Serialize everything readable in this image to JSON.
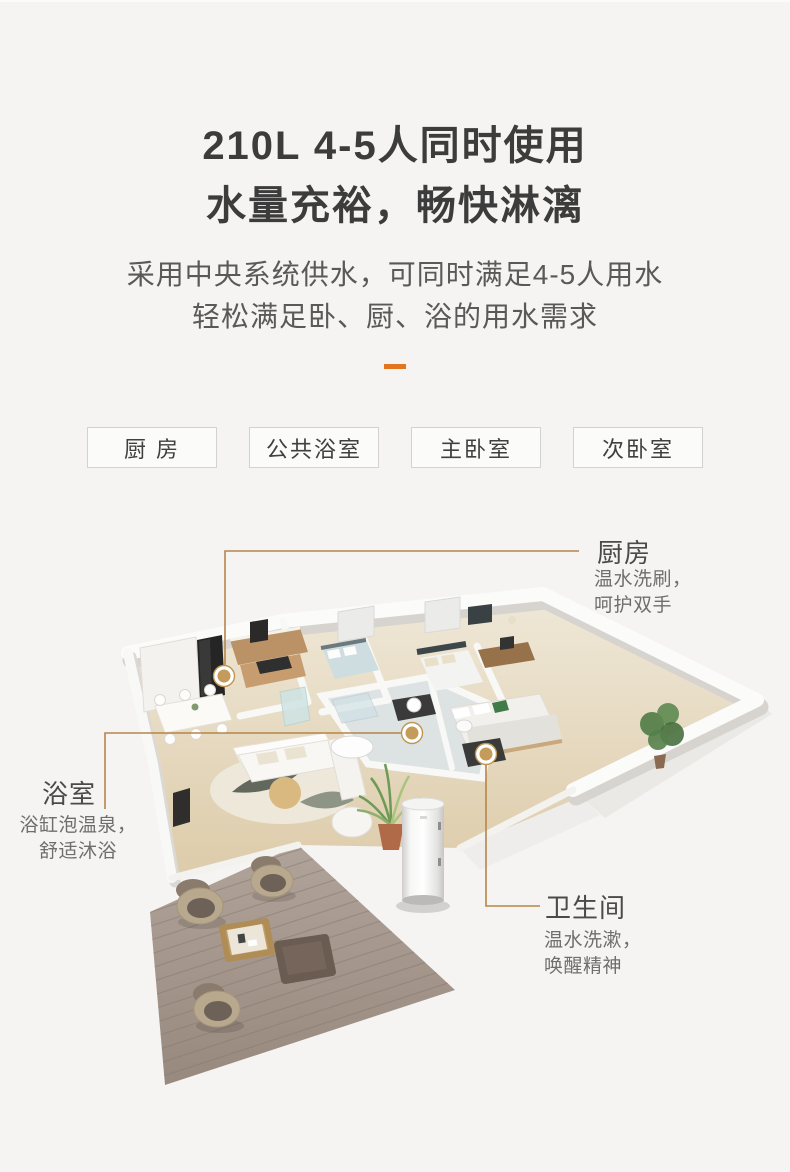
{
  "meta": {
    "background_color": "#f5f4f2",
    "accent_orange": "#e2761e",
    "leader_line_color": "#b5854b",
    "leader_dot_color": "#c49b58"
  },
  "header": {
    "title_line1": "210L 4-5人同时使用",
    "title_line2": "水量充裕，畅快淋漓",
    "subtitle_line1": "采用中央系统供水，可同时满足4-5人用水",
    "subtitle_line2": "轻松满足卧、厨、浴的用水需求"
  },
  "room_tags": [
    {
      "label": "厨 房"
    },
    {
      "label": "公共浴室"
    },
    {
      "label": "主卧室"
    },
    {
      "label": "次卧室"
    }
  ],
  "floorplan_callouts": {
    "kitchen": {
      "title": "厨房",
      "desc_line1": "温水洗刷，",
      "desc_line2": "呵护双手"
    },
    "bathroom": {
      "title": "浴室",
      "desc_line1": "浴缸泡温泉，",
      "desc_line2": "舒适沐浴"
    },
    "toilet": {
      "title": "卫生间",
      "desc_line1": "温水洗漱，",
      "desc_line2": "唤醒精神"
    }
  }
}
